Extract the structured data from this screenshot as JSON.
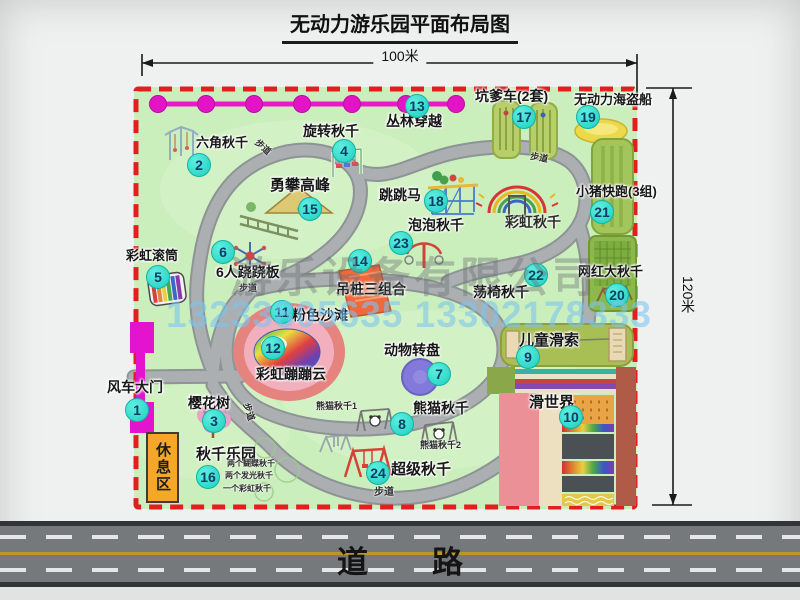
{
  "title": "无动力游乐园平面布局图",
  "dimensions": {
    "top": "100米",
    "right": "120米"
  },
  "road": {
    "label": "道路"
  },
  "watermark": {
    "company": "游乐设备有限公司",
    "phone": "13233805635 13302178333"
  },
  "rest_area": "休息区",
  "colors": {
    "map_green": "#cbeebd",
    "border_red": "#e21f1f",
    "badge_cyan": "#2fe0d2",
    "zipline_magenta": "#ea17cb",
    "road_gray": "#75797c",
    "gate_magenta": "#e414ce"
  },
  "map": {
    "attractions": [
      {
        "num": "1",
        "label": "风车大门",
        "bx": 137,
        "by": 410,
        "lx": 107,
        "ly": 380,
        "fs": 14
      },
      {
        "num": "2",
        "label": "六角秋千",
        "bx": 199,
        "by": 165,
        "lx": 196,
        "ly": 136,
        "fs": 13
      },
      {
        "num": "3",
        "label": "樱花树",
        "bx": 214,
        "by": 421,
        "lx": 188,
        "ly": 396,
        "fs": 14
      },
      {
        "num": "4",
        "label": "旋转秋千",
        "bx": 344,
        "by": 151,
        "lx": 303,
        "ly": 124,
        "fs": 14
      },
      {
        "num": "5",
        "label": "彩虹滚筒",
        "bx": 158,
        "by": 277,
        "lx": 126,
        "ly": 249,
        "fs": 13
      },
      {
        "num": "6",
        "label": "6人跷跷板",
        "bx": 223,
        "by": 252,
        "lx": 216,
        "ly": 265,
        "fs": 14
      },
      {
        "num": "7",
        "label": "动物转盘",
        "bx": 439,
        "by": 374,
        "lx": 384,
        "ly": 343,
        "fs": 14
      },
      {
        "num": "8",
        "label": "熊猫秋千",
        "bx": 402,
        "by": 424,
        "lx": 413,
        "ly": 401,
        "fs": 14
      },
      {
        "num": "9",
        "label": "儿童滑索",
        "bx": 528,
        "by": 357,
        "lx": 519,
        "ly": 333,
        "fs": 15
      },
      {
        "num": "10",
        "label": "滑世界",
        "bx": 571,
        "by": 417,
        "lx": 529,
        "ly": 395,
        "fs": 15
      },
      {
        "num": "11",
        "label": "粉色沙滩",
        "bx": 282,
        "by": 312,
        "lx": 292,
        "ly": 308,
        "fs": 14
      },
      {
        "num": "12",
        "label": "彩虹蹦蹦云",
        "bx": 273,
        "by": 348,
        "lx": 256,
        "ly": 367,
        "fs": 14
      },
      {
        "num": "13",
        "label": "丛林穿越",
        "bx": 417,
        "by": 106,
        "lx": 386,
        "ly": 114,
        "fs": 14
      },
      {
        "num": "14",
        "label": "吊桩三组合",
        "bx": 360,
        "by": 261,
        "lx": 336,
        "ly": 282,
        "fs": 14
      },
      {
        "num": "15",
        "label": "勇攀高峰",
        "bx": 310,
        "by": 209,
        "lx": 270,
        "ly": 178,
        "fs": 15
      },
      {
        "num": "16",
        "label": "秋千乐园",
        "bx": 208,
        "by": 477,
        "lx": 196,
        "ly": 447,
        "fs": 15
      },
      {
        "num": "17",
        "label": "坑爹车(2套)",
        "bx": 524,
        "by": 117,
        "lx": 475,
        "ly": 89,
        "fs": 14
      },
      {
        "num": "18",
        "label": "跳跳马",
        "bx": 436,
        "by": 201,
        "lx": 379,
        "ly": 188,
        "fs": 14
      },
      {
        "num": "19",
        "label": "无动力海盗船",
        "bx": 588,
        "by": 117,
        "lx": 574,
        "ly": 93,
        "fs": 13
      },
      {
        "num": "20",
        "label": "网红大秋千",
        "bx": 617,
        "by": 295,
        "lx": 578,
        "ly": 265,
        "fs": 13
      },
      {
        "num": "21",
        "label": "小猪快跑(3组)",
        "bx": 602,
        "by": 212,
        "lx": 576,
        "ly": 185,
        "fs": 13
      },
      {
        "num": "22",
        "label": "荡椅秋千",
        "bx": 536,
        "by": 275,
        "lx": 473,
        "ly": 285,
        "fs": 14
      },
      {
        "num": "23",
        "label": "泡泡秋千",
        "bx": 401,
        "by": 243,
        "lx": 408,
        "ly": 218,
        "fs": 14
      },
      {
        "num": "24",
        "label": "超级秋千",
        "bx": 378,
        "by": 473,
        "lx": 391,
        "ly": 462,
        "fs": 15
      }
    ],
    "notes": [
      {
        "text": "彩虹秋千",
        "x": 505,
        "y": 215,
        "fs": 14
      },
      {
        "text": "熊猫秋千1",
        "x": 316,
        "y": 402,
        "fs": 9
      },
      {
        "text": "熊猫秋千2",
        "x": 420,
        "y": 441,
        "fs": 9
      },
      {
        "text": "两个蝴蝶秋千",
        "x": 227,
        "y": 460,
        "fs": 8
      },
      {
        "text": "两个发光秋千",
        "x": 225,
        "y": 472,
        "fs": 8
      },
      {
        "text": "一个彩虹秋千",
        "x": 223,
        "y": 485,
        "fs": 8
      },
      {
        "text": "步道",
        "x": 259,
        "y": 138,
        "fs": 9,
        "rot": 42
      },
      {
        "text": "步道",
        "x": 531,
        "y": 152,
        "fs": 9,
        "rot": 10
      },
      {
        "text": "步道",
        "x": 239,
        "y": 284,
        "fs": 9,
        "rot": 0
      },
      {
        "text": "步道",
        "x": 250,
        "y": 402,
        "fs": 9,
        "rot": 72
      },
      {
        "text": "步道",
        "x": 374,
        "y": 488,
        "fs": 10,
        "rot": 0
      }
    ]
  }
}
